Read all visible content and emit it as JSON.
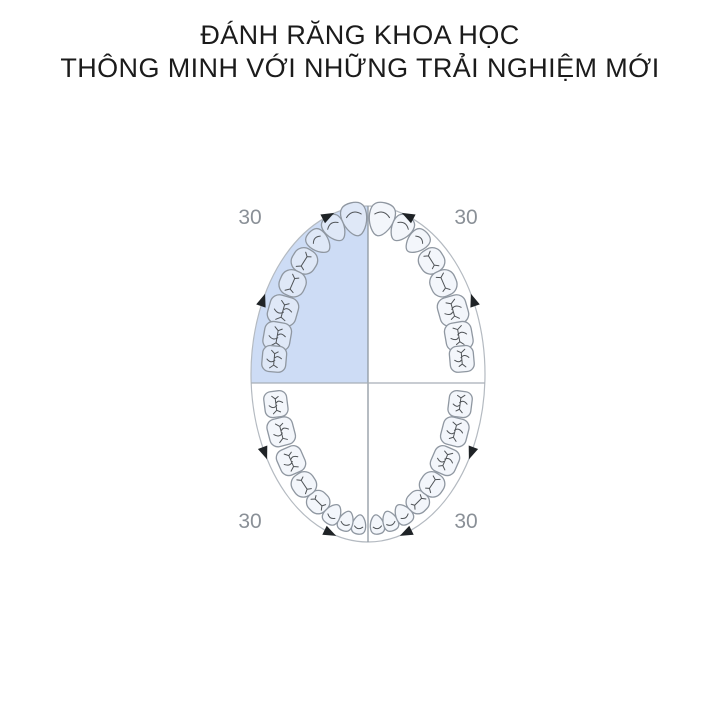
{
  "title": {
    "line1": "ĐÁNH RĂNG KHOA HỌC",
    "line2": "THÔNG MINH VỚI NHỮNG TRẢI NGHIỆM MỚI"
  },
  "diagram": {
    "type": "tooth-brushing-quadrant-timing",
    "seconds_per_quadrant": 30,
    "teeth_per_arch": 16,
    "arches": [
      "upper",
      "lower"
    ],
    "quadrants": [
      {
        "id": "upper-left",
        "time_label": "30",
        "highlighted": true
      },
      {
        "id": "upper-right",
        "time_label": "30",
        "highlighted": false
      },
      {
        "id": "lower-left",
        "time_label": "30",
        "highlighted": false
      },
      {
        "id": "lower-right",
        "time_label": "30",
        "highlighted": false
      }
    ],
    "colors": {
      "background": "#ffffff",
      "highlight": "#cddcf5",
      "tooth_fill": "#f3f6fb",
      "tooth_fill_highlighted": "#dfe8f7",
      "tooth_outline": "#8f97a1",
      "fissure": "#4f5357",
      "ellipse_outline": "#b4bac1",
      "vertical_line": "#8f98a1",
      "horizontal_line": "#a7aeb6",
      "arrow": "#1f2326",
      "quadrant_label": "#8a9097",
      "title_text": "#1b1b1b"
    }
  }
}
